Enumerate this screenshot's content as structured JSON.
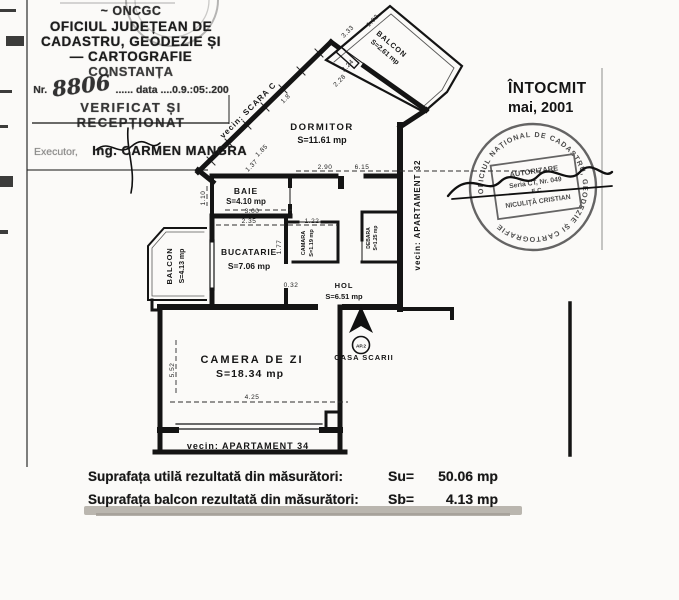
{
  "colors": {
    "paper": "#fbfaf8",
    "ink": "#161616",
    "smudge": "#b6b2ab"
  },
  "header_stamp": {
    "org1": "~ ONCGC",
    "org2": "OFICIUL JUDEȚEAN DE",
    "org3": "CADASTRU, GEODEZIE ȘI",
    "org4": "— CARTOGRAFIE",
    "org5": "CONSTANȚA",
    "nr_prefix": "Nr.",
    "nr_value": "8806",
    "nr_dots": "......",
    "date_label": "data",
    "date_value": "....0.9.:05:.200",
    "received": "VERIFICAT ȘI RECEPȚIONAT",
    "executor_label": "Executor,",
    "executor_name": "Ing. CARMEN MANGRA"
  },
  "intocmit": {
    "label": "ÎNTOCMIT",
    "date": "mai, 2001"
  },
  "round_stamp": {
    "ring": "OFICIUL NAȚIONAL DE CADASTRU, GEODEZIE ȘI CARTOGRAFIE",
    "l1": "AUTORIZARE",
    "l2": "Seria CT, Nr. 049",
    "l3": "E C",
    "l4": "NICULIȚĂ CRISTIAN"
  },
  "plan": {
    "rooms": [
      {
        "id": "dormitor",
        "name": "DORMITOR",
        "area": "S=11.61 mp"
      },
      {
        "id": "baie",
        "name": "BAIE",
        "area": "S=4.10 mp"
      },
      {
        "id": "bucatarie",
        "name": "BUCATARIE",
        "area": "S=7.06 mp"
      },
      {
        "id": "balcon-left",
        "name": "BALCON",
        "area": "S=4.13 mp"
      },
      {
        "id": "balcon-top",
        "name": "BALCON",
        "area": "S=2.61 mp"
      },
      {
        "id": "camara",
        "name": "CAMARA",
        "area": "S=1.19 mp"
      },
      {
        "id": "debara",
        "name": "DEBARA",
        "area": "S=1.25 mp"
      },
      {
        "id": "hol",
        "name": "HOL",
        "area": "S=6.51 mp"
      },
      {
        "id": "camera-de-zi",
        "name": "CAMERA DE ZI",
        "area": "S=18.34 mp"
      }
    ],
    "neighbors": {
      "scara": "vecin: SCARA C",
      "ap32": "vecin: APARTAMENT 32",
      "ap34": "vecin: APARTAMENT 34",
      "casa_scarii": "CASA SCARII",
      "ap_badge": "AP.2"
    },
    "dimensions": {
      "d185": "1.85",
      "d137": "1.37",
      "d110": "1.10",
      "d300": "3.00",
      "d235": "2.35",
      "d122": "1.22",
      "d177": "1.77",
      "d290": "2.90",
      "d615": "6.15",
      "d224": "2.24",
      "d228": "2.28",
      "d18": "1.8",
      "d333": "3.33",
      "d102": "1.02",
      "d425": "4.25",
      "d552": "5.52",
      "d032": "0.32"
    }
  },
  "summary": {
    "row1_label": "Suprafața utilă rezultată din măsurători:",
    "row1_key": "Su=",
    "row1_value": "50.06 mp",
    "row2_label": "Suprafața balcon rezultată din măsurători:",
    "row2_key": "Sb=",
    "row2_value": "4.13 mp"
  }
}
